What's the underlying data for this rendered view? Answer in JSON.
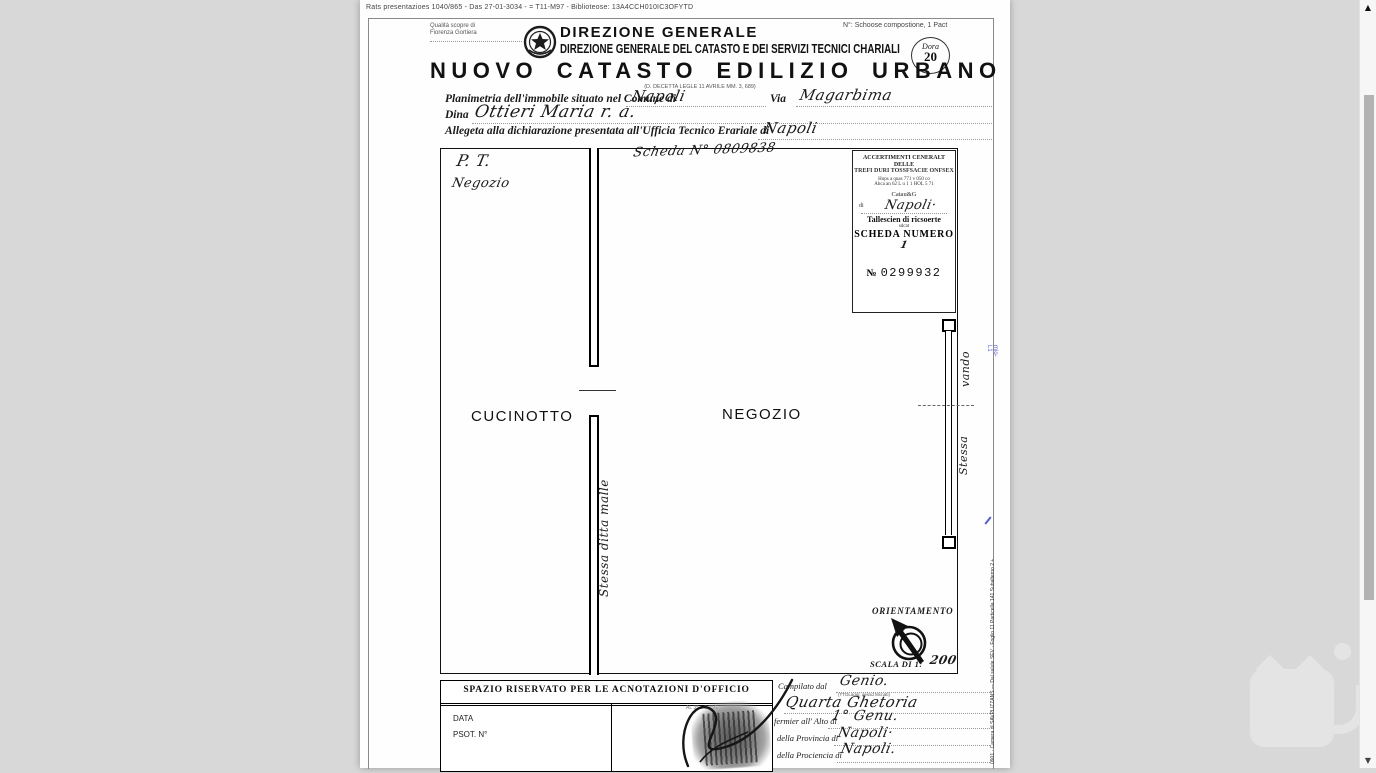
{
  "viewer": {
    "top_meta": "Rats presentazioes 1040/865 - Das 27-01-3034 - = T11-M97 - Biblioteose: 13A4CCH010IC3OFYTD"
  },
  "icons": {
    "scroll_up": "▲",
    "scroll_down": "▼"
  },
  "header": {
    "quality_line1": "Qualità scopre di",
    "quality_line2": "Fiorenza Gortiera",
    "dept_line1": "DIREZIONE GENERALE",
    "dept_line2": "DIREZIONE GENERALE DEL CATASTO E DEI SERVIZI TECNICI CHARIALI",
    "right_note": "N°: Schoose compostione, 1 Pact",
    "stamp_circle_label": "Dora",
    "stamp_circle_number": "20",
    "title": "NUOVO CATASTO EDILIZIO URBANO",
    "title_sub": "(D. DECETTA LEGLE 11 AVRILE MM. 3, 689)"
  },
  "form": {
    "comune_label": "Planimetria dell'immobile situato nel Comune di",
    "comune_value": "Napoli",
    "via_label": "Via",
    "via_value": "Magarbima",
    "ditta_label": "Dina",
    "ditta_value": "Ottieri Maria r. a.",
    "ufficio_label": "Allegeta alla dichiarazione presentata all'Ufficia Tecnico Erariale di",
    "ufficio_value": "Napoli"
  },
  "plan": {
    "scheda_note": "Scheda N° 0809838",
    "floor_code": "P. T.",
    "floor_use": "Negozio",
    "room_left": "CUCINOTTO",
    "room_right": "NEGOZIO",
    "wall_note": "Stessa ditta malle",
    "window_note_top": "vando",
    "window_note_bottom": "Stessa"
  },
  "ricevuta": {
    "line1": "ACCERTIMENTI CENERALT DELLE",
    "line2": "TREFI DURI TOSSFSACIE ONFSEX",
    "line3": "Hops a quas 771 v 050 co",
    "line4": "Ahca an 62 L u 1 1 HOL 5 71",
    "catasto": "Catau&G",
    "di_label": "di",
    "di_value": "Napoli·",
    "talloncino": "Tallescien di ricsoerte",
    "small_word": "sdcat",
    "scheda_label": "SCHEDA NUMERO",
    "scheda_value": "1",
    "numero_label": "№",
    "numero_value": "0299932"
  },
  "orientamento": {
    "label": "ORIENTAMENTO",
    "scala_label": "SCALA DI 1:",
    "scala_value": "200"
  },
  "annotazioni": {
    "header": "SPAZIO RISERVATO PER LE ACNOTAZIONI D'OFFICIO",
    "data_label": "DATA",
    "prot_label": "PSOT. N°",
    "stamp_note": "AL 35 z 6 55G"
  },
  "compilazione": {
    "compilato_label": "Campilato dal",
    "compilato_value": "Genio.",
    "note": "(TTOLaggi: qessd Mcnati)",
    "qualifica_value": "Quarta Ghetoria",
    "albo_label": "fermier all' Alto di",
    "albo_value": "1° Genu.",
    "provincia_label": "della Provincia di",
    "provincia_value": "Napoli·",
    "provincia2_label": "della Prociencia di",
    "provincia2_value": "Napoli."
  },
  "margin": {
    "blue_note": "mio-L1",
    "bottom_note": "0901 · Camera di SAVPLIZZANS — Dal salute SEV · Foglio 11 Particella 141 Subalterno 2 +"
  },
  "colors": {
    "background": "#d8d8d8",
    "paper": "#fefefe",
    "ink": "#1a1a1a",
    "blue_annotation": "#5b5bd0",
    "scroll_thumb": "#b2b2b2",
    "watermark": "#e4e4e4"
  }
}
